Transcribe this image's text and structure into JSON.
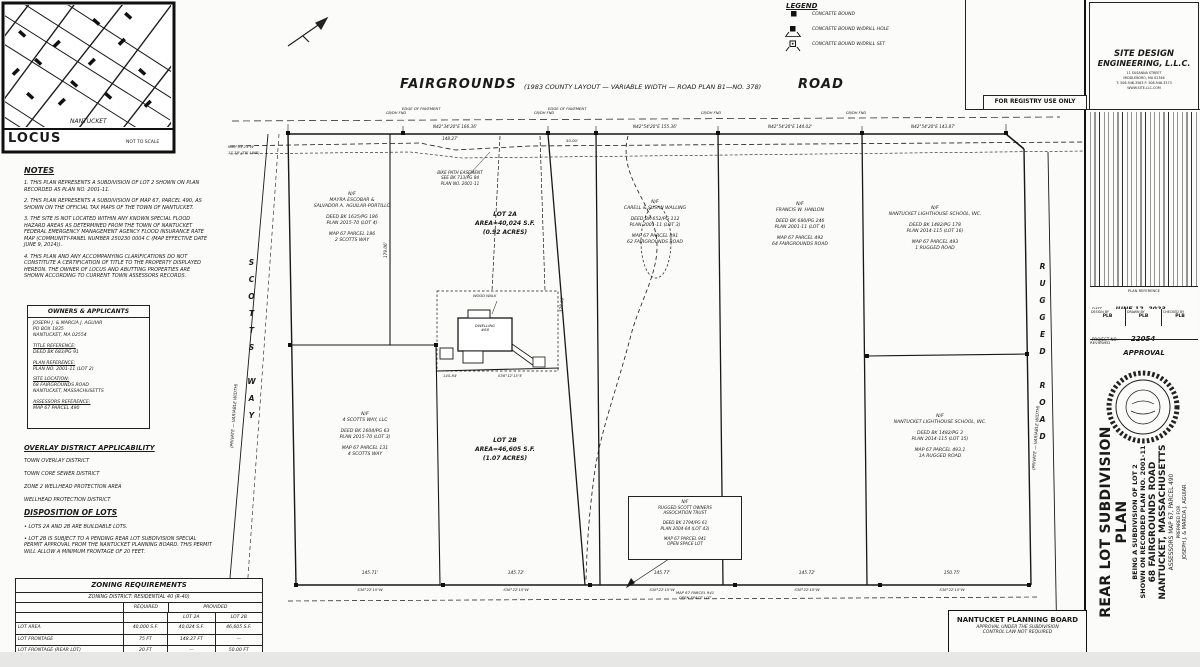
{
  "locus": {
    "region_label": "NANTUCKET",
    "title": "LOCUS",
    "scale_note": "NOT TO SCALE"
  },
  "legend": {
    "title": "LEGEND",
    "items": [
      "CONCRETE BOUND",
      "CONCRETE BOUND W/DRILL HOLE",
      "CONCRETE BOUND W/DRILL SET"
    ]
  },
  "road_header": {
    "left": "FAIRGROUNDS",
    "center": "(1983 COUNTY LAYOUT  —  VARIABLE WIDTH  —  ROAD PLAN B1—NO. 378)",
    "right": "ROAD"
  },
  "notes": {
    "title": "NOTES",
    "items": [
      "1.  THIS PLAN REPRESENTS A SUBDIVISION OF LOT 2 SHOWN ON PLAN RECORDED AS PLAN NO. 2001-11.",
      "2.  THIS PLAN REPRESENTS A SUBDIVISION OF MAP 67, PARCEL 490, AS SHOWN ON THE OFFICIAL TAX MAPS OF THE TOWN OF NANTUCKET.",
      "3.  THE SITE IS NOT LOCATED WITHIN ANY KNOWN SPECIAL FLOOD HAZARD AREAS AS DETERMINED FROM THE TOWN OF NANTUCKET FEDERAL EMERGENCY MANAGEMENT AGENCY FLOOD INSURANCE RATE MAP (COMMUNITY-PANEL NUMBER 250230 0004 C (MAP EFFECTIVE DATE JUNE 9, 2014)).",
      "4.  THIS PLAN AND ANY ACCOMPANYING CLARIFICATIONS DO NOT CONSTITUTE A CERTIFICATION OF TITLE TO THE PROPERTY DISPLAYED HEREON. THE OWNER OF LOCUS AND ABUTTING PROPERTIES ARE SHOWN ACCORDING TO CURRENT TOWN ASSESSORS RECORDS."
    ]
  },
  "owners": {
    "title": "OWNERS & APPLICANTS",
    "lines": [
      "JOSEPH J. & MARCIA J. AGUIAR",
      "PO BOX 1835",
      "NANTUCKET, MA 02554",
      "",
      "TITLE REFERENCE:",
      "DEED BK 683/PG 91",
      "",
      "PLAN REFERENCE:",
      "PLAN NO. 2001-11 (LOT 2)",
      "",
      "SITE LOCATION:",
      "68 FAIRGROUNDS ROAD",
      "NANTUCKET, MASSACHUSETTS",
      "",
      "ASSESSORS REFERENCE:",
      "MAP 67  PARCEL 490"
    ]
  },
  "overlay": {
    "title": "OVERLAY DISTRICT APPLICABILITY",
    "items": [
      "TOWN OVERLAY DISTRICT",
      "TOWN CORE SEWER DISTRICT",
      "ZONE 2 WELLHEAD PROTECTION AREA",
      "WELLHEAD PROTECTION DISTRICT"
    ]
  },
  "disposition": {
    "title": "DISPOSITION OF LOTS",
    "items": [
      "•  LOTS 2A AND 2B ARE BUILDABLE LOTS.",
      "•  LOT 2B IS SUBJECT TO A PENDING REAR LOT SUBDIVISION SPECIAL PERMIT APPROVAL FROM THE NANTUCKET PLANNING BOARD. THIS PERMIT WILL ALLOW A MINIMUM FRONTAGE OF 20 FEET."
    ]
  },
  "zoning": {
    "title": "ZONING REQUIREMENTS",
    "district": "ZONING DISTRICT:  RESIDENTIAL 40 (R-40)",
    "col_required": "REQUIRED",
    "col_provided": "PROVIDED",
    "col_lot2a": "LOT 2A",
    "col_lot2b": "LOT 2B",
    "rows": [
      [
        "LOT AREA",
        "40,000 S.F.",
        "40,024 S.F.",
        "46,605 S.F."
      ],
      [
        "LOT FRONTAGE",
        "75 FT",
        "148.27 FT",
        "—"
      ],
      [
        "LOT FRONTAGE (REAR LOT)",
        "20 FT",
        "—",
        "50.00 FT"
      ],
      [
        "FRONT YARD SETBACK",
        "25 FT",
        "104.4 FT",
        "—"
      ],
      [
        "REAR/SIDE YARD SETBACK",
        "10 FT",
        "101.1 FT",
        "—"
      ]
    ]
  },
  "plan": {
    "streets": {
      "scotts_way": "SCOTTS WAY",
      "scotts_way_note": "(PRIVATE  —  VARIABLE WIDTH)",
      "rugged_road": "RUGGED ROAD",
      "rugged_road_note": "(PRIVATE  —  VARIABLE WIDTH)"
    },
    "lots": {
      "lot2a": [
        "LOT 2A",
        "AREA=40,024 S.F.",
        "(0.92 ACRES)"
      ],
      "lot2b": [
        "LOT 2B",
        "AREA=46,605 S.F.",
        "(1.07 ACRES)"
      ]
    },
    "parcels": [
      {
        "lines": [
          "N/F",
          "MAYRA ESCOBAR &",
          "SALVADOR A. AGUILAR-PORTILLO",
          "",
          "DEED BK 1635/PG 186",
          "PLAN 2015-70 (LOT 4)",
          "",
          "MAP 67  PARCEL 186",
          "2 SCOTTS WAY"
        ]
      },
      {
        "lines": [
          "N/F",
          "CARELL & SUSAN WALLING",
          "",
          "DEED BK 652/PG 112",
          "PLAN 2001-11 (LOT 3)",
          "",
          "MAP 67  PARCEL 491",
          "62 FAIRGROUNDS ROAD"
        ]
      },
      {
        "lines": [
          "N/F",
          "FRANCIS W. HANLON",
          "",
          "DEED BK 680/PG 246",
          "PLAN 2001-11 (LOT 4)",
          "",
          "MAP 67  PARCEL 492",
          "64 FAIRGROUNDS ROAD"
        ]
      },
      {
        "lines": [
          "N/F",
          "NANTUCKET LIGHTHOUSE SCHOOL, INC.",
          "",
          "DEED BK 1482/PG 178",
          "PLAN 2014-115 (LOT 16)",
          "",
          "MAP 67  PARCEL 493",
          "1 RUGGED ROAD"
        ]
      },
      {
        "lines": [
          "N/F",
          "4 SCOTTS WAY, LLC",
          "",
          "DEED BK 1604/PG 63",
          "PLAN 2015-70 (LOT 3)",
          "",
          "MAP 67  PARCEL 131",
          "4 SCOTTS WAY"
        ]
      },
      {
        "lines": [
          "N/F",
          "NANTUCKET LIGHTHOUSE SCHOOL, INC.",
          "",
          "DEED BK 1482/PG 3",
          "PLAN 2014-115 (LOT 15)",
          "",
          "MAP 67  PARCEL 493.1",
          "1A RUGGED ROAD"
        ]
      },
      {
        "lines": [
          "N/F",
          "RUGGED SCOTT OWNERS",
          "ASSOCIATION TRUST",
          "",
          "DEED BK 1794/PG 61",
          "PLAN 2004-64 (LOT 43)",
          "",
          "MAP 67  PARCEL 941",
          "OPEN SPACE LOT"
        ]
      }
    ],
    "easement_note": [
      "BIKE PATH EASEMENT",
      "SEE BK 713/PG 84",
      "PLAN NO. 2001-11"
    ],
    "open_space_note": [
      "MAP 67  PARCEL 941",
      "OPEN SPACE LOT"
    ],
    "house": {
      "walk_label": "WOOD WALK",
      "lines": [
        "DWELLING",
        "#68"
      ]
    },
    "dims": {
      "top1_bearing": "N42°34'20\"E   166.36'",
      "top1_below": "148.27'",
      "frontage_2b": "50.00'",
      "top2_bearing": "N42°54'20\"E   155.36'",
      "top3_bearing": "N42°54'20\"E   144.02'",
      "top4_bearing": "N42°54'20\"E   143.87'",
      "tie_left_1": "N50°03'23\"W",
      "tie_left_2": "17.78'  (TIE LINE)",
      "west_line": "179.06'",
      "stem_west": "328.06'",
      "lot2a_south_len": "145.84'",
      "lot2a_south_bearing": "S36°12'15\"E",
      "bot1_len": "145.71'",
      "bot1_bearing": "S38°22'15\"W",
      "bot2_len": "145.72'",
      "bot2_bearing": "S38°22'15\"W",
      "bot3_len": "145.77'",
      "bot3_bearing": "S38°22'15\"W",
      "bot4_len": "145.72'",
      "bot4_bearing": "S38°22'15\"W",
      "bot5_len": "150.75'",
      "bot5_bearing": "S38°22'15\"W",
      "cb_label": "CB/DH FND",
      "edge_pavement": "EDGE OF PAVEMENT"
    }
  },
  "titleblock": {
    "firm_line1": "SITE DESIGN",
    "firm_line2": "ENGINEERING, L.L.C.",
    "firm_addr": [
      "11 SUSANNA STREET",
      "MIDDLEBORO, MA 02346",
      "T: 508-946-3563   F: 508-946-3573",
      "WWW.SITE-LLC.COM"
    ],
    "registry": "FOR REGISTRY USE ONLY",
    "plan_ref_label": "PLAN REFERENCE",
    "date_label": "DATE",
    "date_value": "JUNE 12, 2023",
    "cells": [
      [
        "DESIGN BY",
        "PLB"
      ],
      [
        "DRAWN BY",
        "PLB"
      ],
      [
        "CHECKED BY",
        "PLB"
      ]
    ],
    "project_label": "PROJECT NO.",
    "project_value": "22054",
    "review_label": "REVIEWED",
    "approval_label": "APPROVAL",
    "title_lines": {
      "main": "REAR LOT SUBDIVISION PLAN",
      "sub1": "BEING A SUBDIVISION OF LOT 2",
      "sub2": "SHOWN ON RECORDED PLAN NO. 2001-11",
      "addr1": "68 FAIRGROUNDS ROAD",
      "addr2": "NANTUCKET, MASSACHUSETTS",
      "assessors": "ASSESSORS MAP 67, PARCEL 490",
      "prepared_for": "PREPARED FOR",
      "client": "JOSEPH J. & MARCIA J. AGUIAR"
    },
    "planning_board": [
      "NANTUCKET PLANNING BOARD",
      "APPROVAL UNDER THE SUBDIVISION",
      "CONTROL LAW NOT REQUIRED"
    ]
  }
}
